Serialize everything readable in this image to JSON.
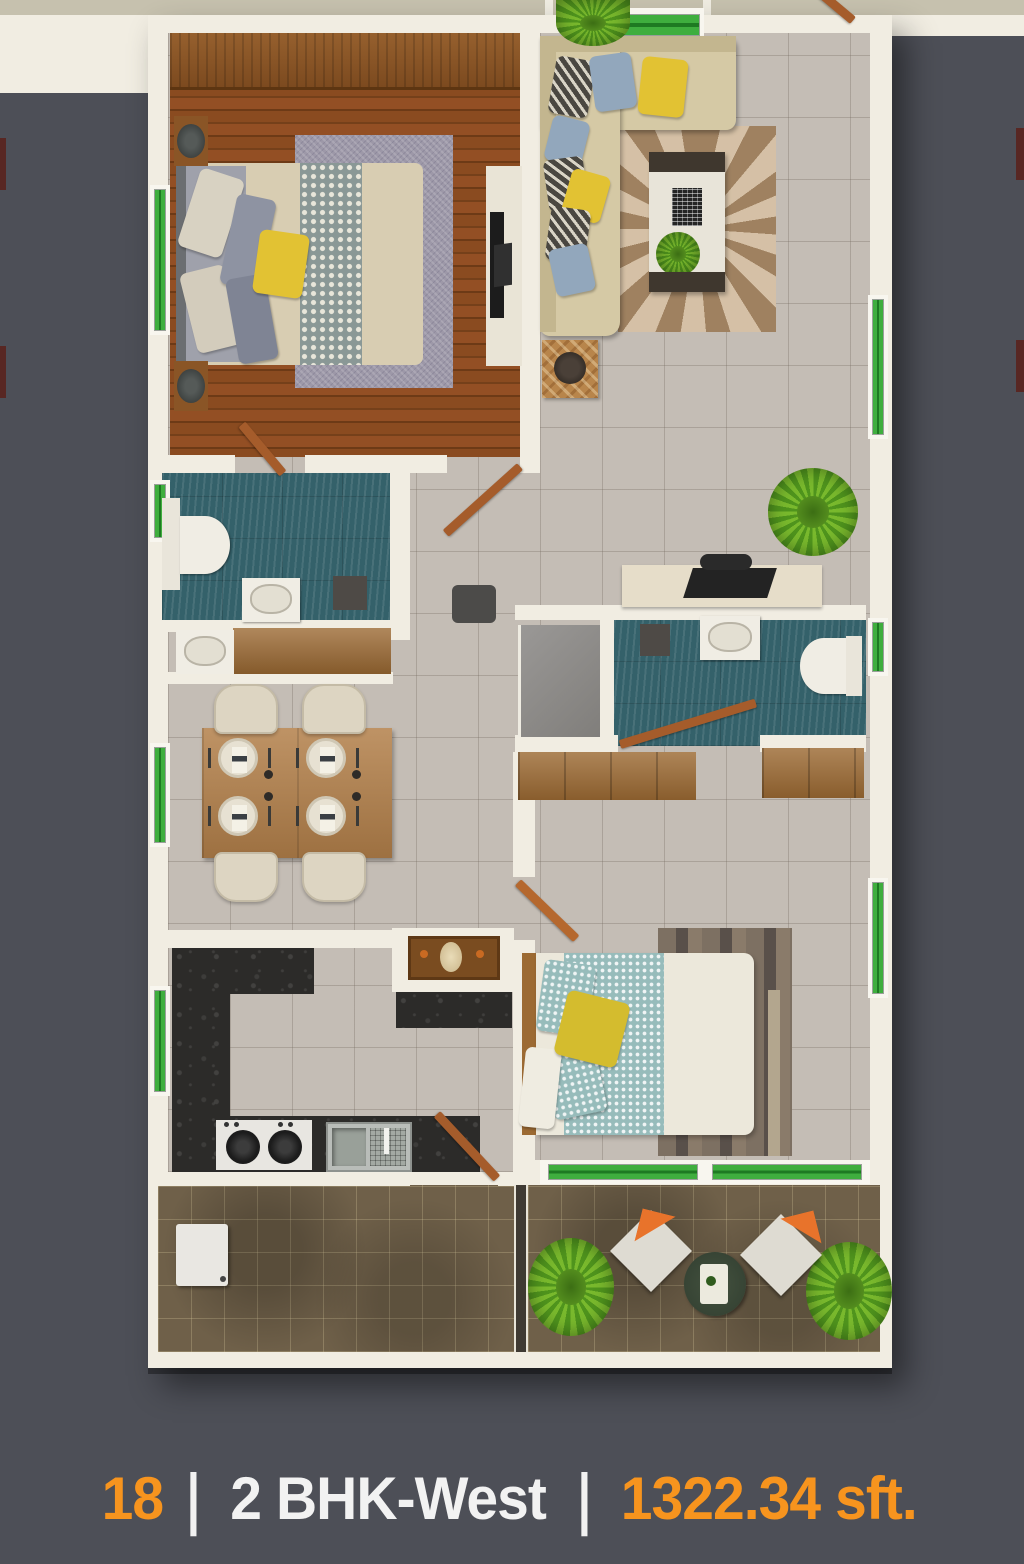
{
  "caption": {
    "unit_number": "18",
    "separator": "|",
    "unit_type": "2 BHK-West",
    "unit_area": "1322.34 sft."
  },
  "theme": {
    "bg": "#4d4f57",
    "wall": "#f1ede2",
    "tile": "#c4bdb5",
    "teal": "#34616a",
    "balc": "#6f6049",
    "granite": "#2c2b29",
    "sofa": "#d5c9a5",
    "wingreen": "#3fae3e",
    "wingreendk": "#1e7a22",
    "door": "#a55c2b",
    "orange": "#f7941e",
    "light": "#f2f2f2",
    "duvet": "#ece8db",
    "bedbeige": "#d8cdb2",
    "runner": "#97bcbb",
    "pyellow": "#e2c233",
    "porange": "#e8732b"
  },
  "plan": {
    "rooms": [
      {
        "name": "master-bedroom",
        "furniture": [
          "wardrobe",
          "double-bed",
          "pillows",
          "area-rug",
          "nightstand-lamps",
          "tv-unit"
        ]
      },
      {
        "name": "living-room",
        "furniture": [
          "l-shaped-sofa",
          "throw-pillows",
          "floral-rug",
          "coffee-table",
          "side-table",
          "indoor-plant",
          "entrance-door"
        ]
      },
      {
        "name": "master-bathroom",
        "furniture": [
          "toilet",
          "wash-basin",
          "bath-mat"
        ]
      },
      {
        "name": "wash-vanity",
        "furniture": [
          "wash-basin",
          "wooden-counter"
        ]
      },
      {
        "name": "common-bathroom",
        "furniture": [
          "toilet",
          "wash-basin",
          "shower-mat"
        ]
      },
      {
        "name": "study-nook",
        "furniture": [
          "desk",
          "laptop",
          "chair",
          "gray-cabinet"
        ]
      },
      {
        "name": "dining-area",
        "furniture": [
          "dining-table",
          "four-chairs",
          "place-settings"
        ]
      },
      {
        "name": "kitchen",
        "furniture": [
          "granite-counters",
          "gas-hob",
          "double-sink",
          "pooja-unit"
        ]
      },
      {
        "name": "bedroom-2",
        "furniture": [
          "double-bed",
          "pillows",
          "wood-rug",
          "wardrobes"
        ]
      },
      {
        "name": "utility-balcony",
        "furniture": [
          "washing-machine"
        ]
      },
      {
        "name": "sit-out-balcony",
        "furniture": [
          "lounge-chair",
          "lounge-chair",
          "round-table",
          "planter",
          "planter"
        ]
      }
    ]
  }
}
